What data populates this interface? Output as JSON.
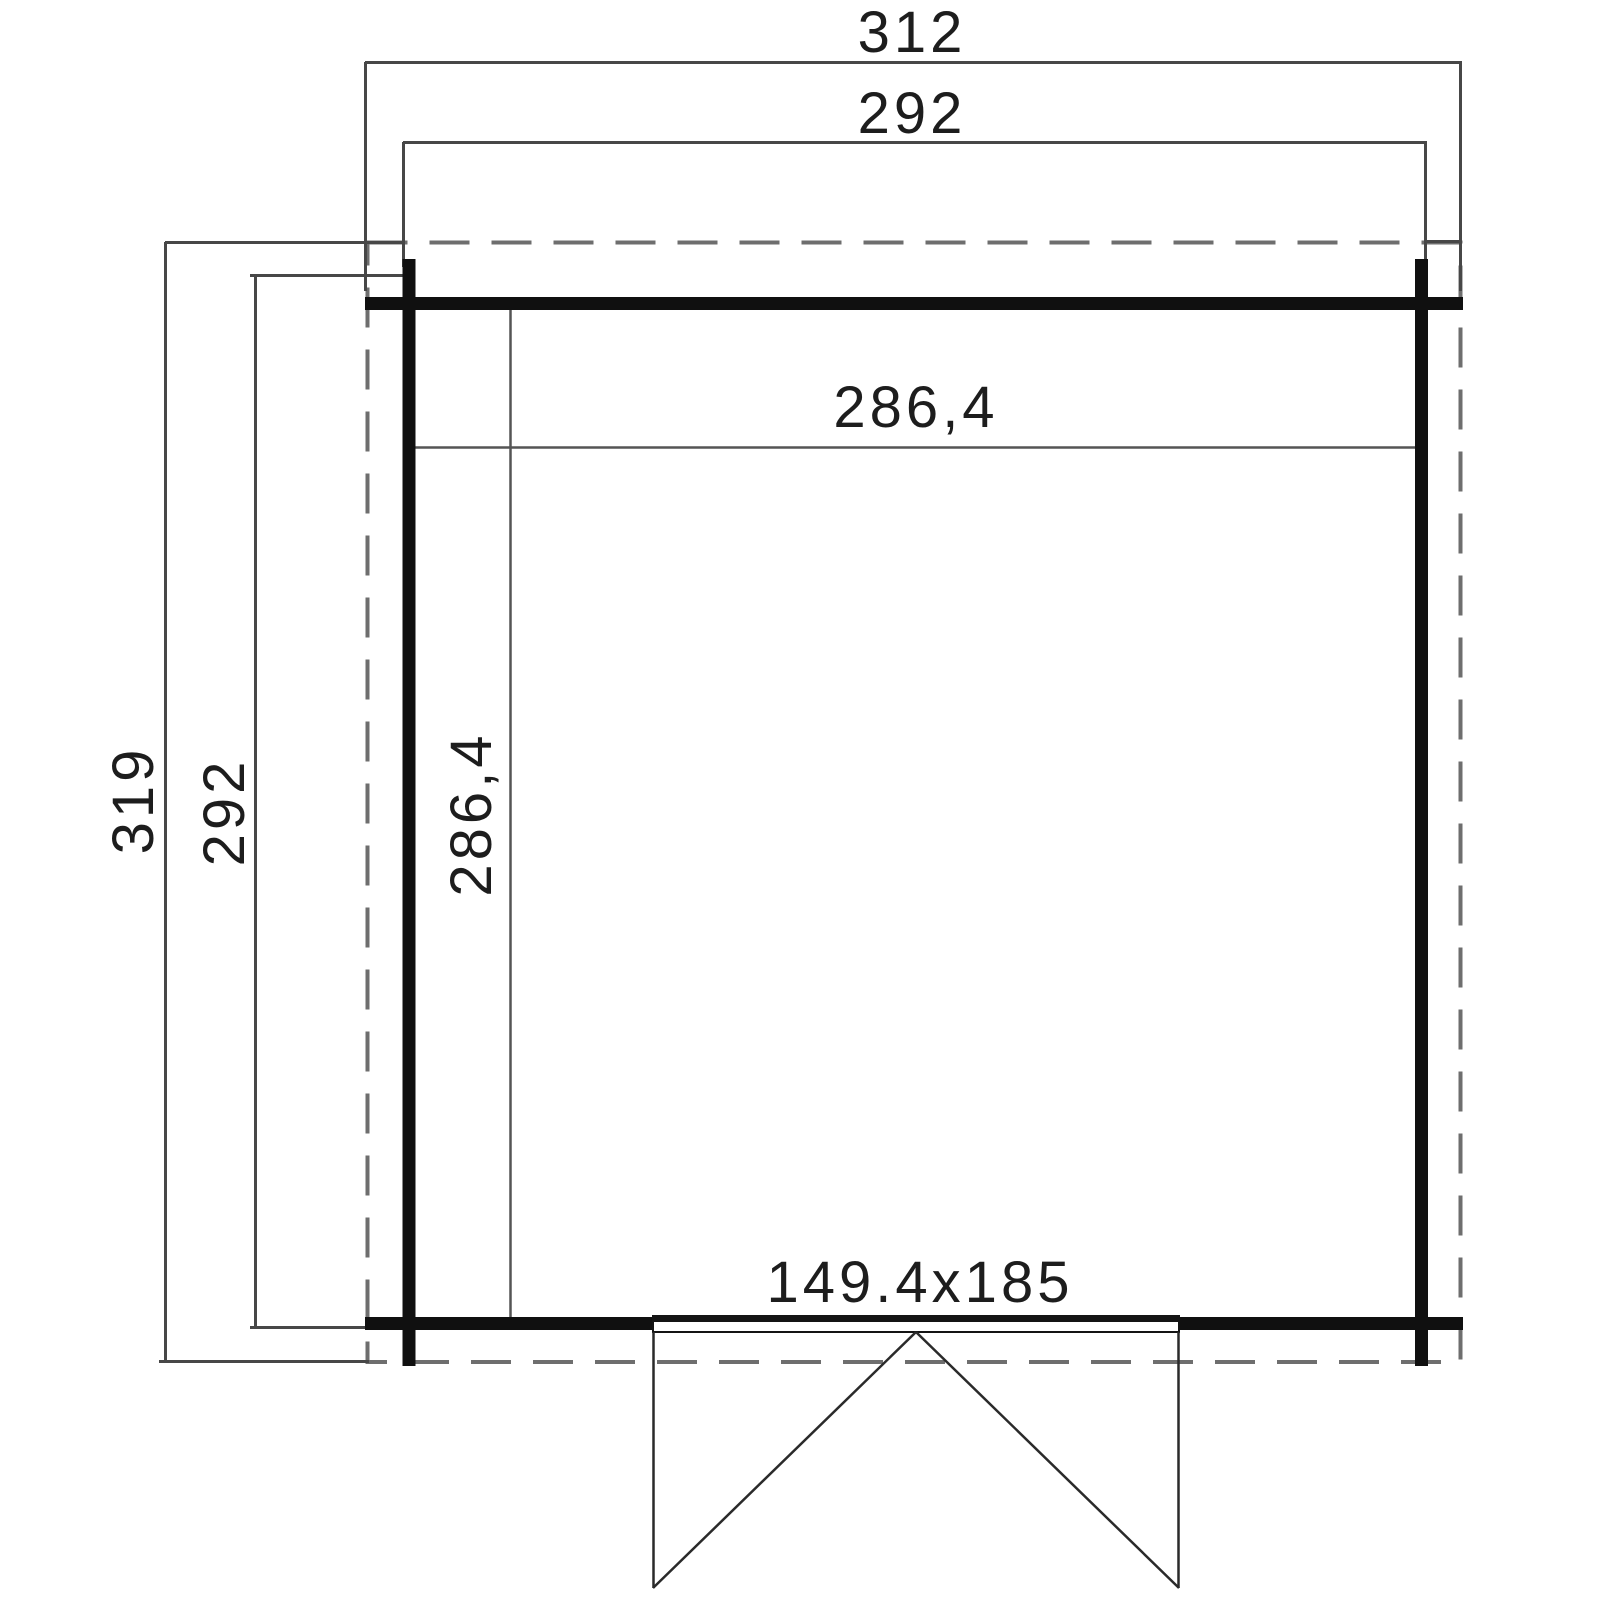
{
  "drawing": {
    "type": "floor-plan",
    "colors": {
      "background": "#ffffff",
      "wall": "#101010",
      "thin_line": "#474747",
      "dashed_outline": "#6e6e6e",
      "text": "#1d1d1d"
    },
    "dimensions": {
      "outer_width": "312",
      "wall_width": "292",
      "outer_depth": "319",
      "wall_depth": "292",
      "interior_width": "286,4",
      "interior_depth": "286,4",
      "door_size": "149.4x185"
    }
  }
}
